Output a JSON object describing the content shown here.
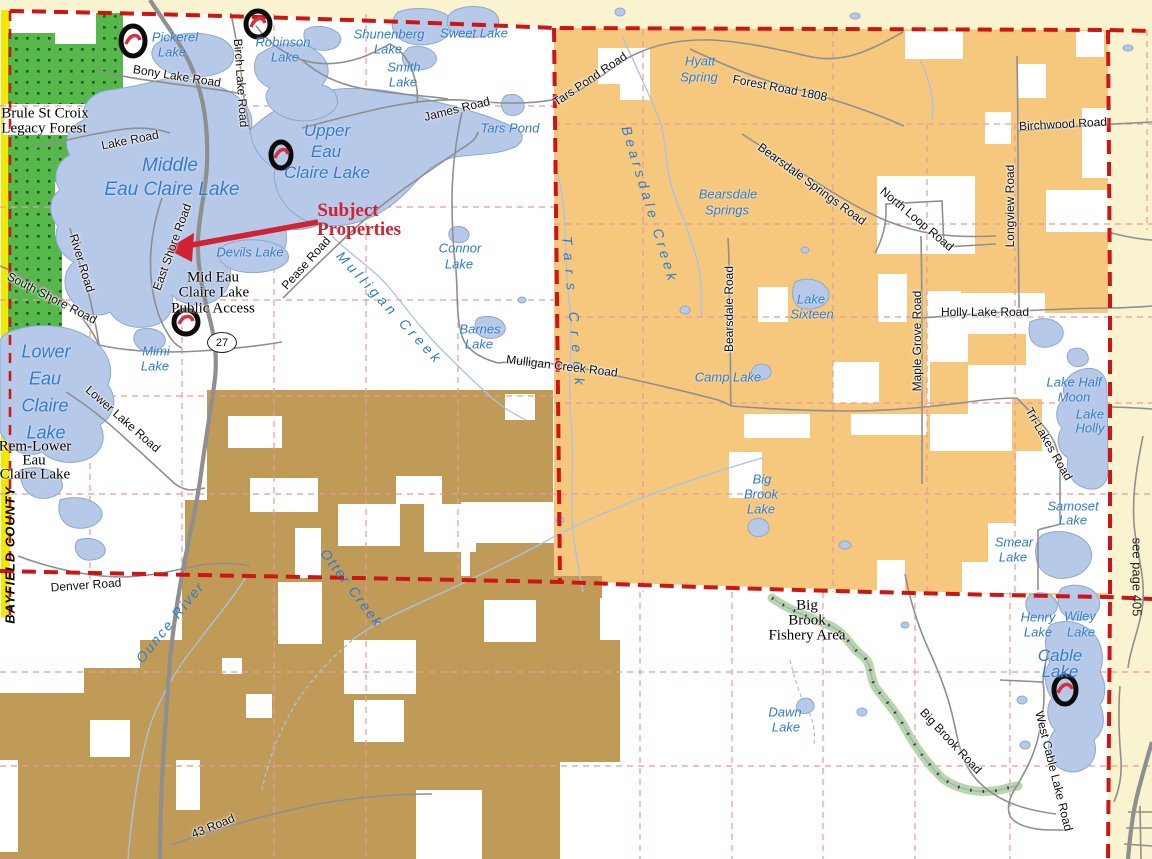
{
  "colors": {
    "boundary_red": "#cc1616",
    "section_pink": "#e89a9a",
    "plat_orange": "#f6c87d",
    "plat_brown": "#c09b58",
    "forest_green": "#56b84a",
    "forest_dot": "#1e5c1e",
    "lake_fill": "#b7c9e8",
    "lake_stroke": "#8fa8cc",
    "water_label_blue": "#2e7bcf",
    "road_gray": "#8f8f8f",
    "outside_cream": "#faf3cf",
    "county_strip_yellow": "#f2e900",
    "annotation_red": "#cf2233",
    "fishery_green": "#b9d6a9"
  },
  "labels": {
    "lakes": {
      "pickerel": [
        "Pickerel",
        "Lake"
      ],
      "robinson": [
        "Robinson",
        "Lake"
      ],
      "shunenberg": [
        "Shunenberg",
        "Lake"
      ],
      "sweet": [
        "Sweet Lake"
      ],
      "smith": [
        "Smith",
        "Lake"
      ],
      "tars_pond": [
        "Tars Pond"
      ],
      "upper": [
        "Upper",
        "Eau",
        "Claire Lake"
      ],
      "middle": [
        "Middle",
        "Eau Claire Lake"
      ],
      "devils": [
        "Devils Lake"
      ],
      "connor": [
        "Connor",
        "Lake"
      ],
      "barnes": [
        "Barnes",
        "Lake"
      ],
      "mimi": [
        "Mimi",
        "Lake"
      ],
      "lower": [
        "Lower",
        "Eau",
        "Claire",
        "Lake"
      ],
      "hyatt": [
        "Hyatt",
        "Spring"
      ],
      "bearsdale_springs": [
        "Bearsdale",
        "Springs"
      ],
      "sixteen": [
        "Lake",
        "Sixteen"
      ],
      "camp": [
        "Camp Lake"
      ],
      "big_brook": [
        "Big",
        "Brook",
        "Lake"
      ],
      "half_moon": [
        "Lake Half",
        "Moon"
      ],
      "holly": [
        "Lake",
        "Holly"
      ],
      "samoset": [
        "Samoset",
        "Lake"
      ],
      "smear": [
        "Smear",
        "Lake"
      ],
      "henry": [
        "Henry",
        "Lake"
      ],
      "wiley": [
        "Wiley",
        "Lake"
      ],
      "cable": [
        "Cable",
        "Lake"
      ],
      "dawn": [
        "Dawn",
        "Lake"
      ]
    },
    "creeks": {
      "bearsdale": "Bearsdale Creek",
      "tars": "Tars Creek",
      "mulligan": "Mulligan Creek",
      "otter": "Otter Creek",
      "ounce": "Ounce River"
    },
    "roads": {
      "bony": "Bony Lake Road",
      "birch": "Birch Lake Road",
      "lake_rd": "Lake Road",
      "river": "River Road",
      "south_shore": "South Shore Road",
      "east_shore": "East Shore Road",
      "pease": "Pease Road",
      "james": "James Road",
      "tars_pond_rd": "Tars Pond Road",
      "forest_1808": "Forest Road 1808",
      "bearsdale_springs_rd": "Bearsdale Springs Road",
      "birchwood": "Birchwood Road",
      "longview": "Longview Road",
      "north_loop": "North Loop Road",
      "bearsdale_rd": "Bearsdale Road",
      "maple_grove": "Maple Grove Road",
      "holly_lake": "Holly Lake Road",
      "mulligan_creek_rd": "Mulligan Creek Road",
      "tri_lakes": "Tri-Lakes Road",
      "lower_lake": "Lower Lake Road",
      "denver": "Denver Road",
      "big_brook_rd": "Big Brook Road",
      "west_cable": "West Cable Lake Road",
      "rd43": "43 Road"
    },
    "areas": {
      "legacy_forest": [
        "Brule St Croix",
        "Legacy Forest"
      ],
      "public_access": [
        "Mid Eau",
        "Claire Lake",
        "Public Access"
      ],
      "rem_lower": [
        "Rem-Lower",
        "Eau",
        "Claire Lake"
      ],
      "fishery": [
        "Big",
        "Brook",
        "Fishery Area"
      ]
    },
    "annotations": {
      "subject": [
        "Subject",
        "Properties"
      ],
      "county": "BAYFIELD COUNTY",
      "page_ref": "see page 405",
      "highway_shield": "27"
    }
  }
}
